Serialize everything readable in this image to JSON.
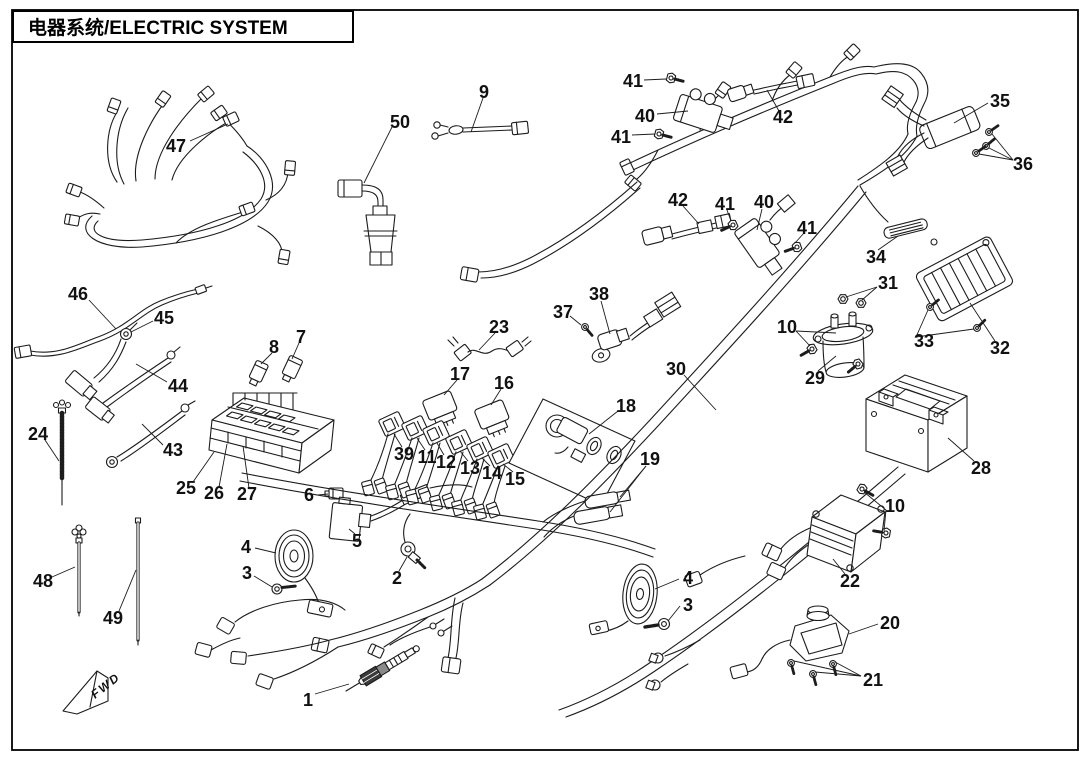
{
  "header": {
    "title": "电器系统/ELECTRIC SYSTEM"
  },
  "fwd_marker": {
    "label": "FWD"
  },
  "diagram": {
    "type": "exploded-parts-diagram",
    "subject": "Electric system wiring harness and components with numbered callouts",
    "callouts": [
      {
        "n": "47",
        "x": 176,
        "y": 146
      },
      {
        "n": "50",
        "x": 400,
        "y": 122
      },
      {
        "n": "9",
        "x": 484,
        "y": 92
      },
      {
        "n": "41",
        "x": 633,
        "y": 81
      },
      {
        "n": "40",
        "x": 645,
        "y": 116
      },
      {
        "n": "41",
        "x": 621,
        "y": 137
      },
      {
        "n": "42",
        "x": 783,
        "y": 117
      },
      {
        "n": "35",
        "x": 1000,
        "y": 101
      },
      {
        "n": "36",
        "x": 1023,
        "y": 164
      },
      {
        "n": "42",
        "x": 678,
        "y": 200
      },
      {
        "n": "41",
        "x": 725,
        "y": 204
      },
      {
        "n": "40",
        "x": 764,
        "y": 202
      },
      {
        "n": "41",
        "x": 807,
        "y": 228
      },
      {
        "n": "34",
        "x": 876,
        "y": 257
      },
      {
        "n": "31",
        "x": 888,
        "y": 283
      },
      {
        "n": "10",
        "x": 787,
        "y": 327
      },
      {
        "n": "29",
        "x": 815,
        "y": 378
      },
      {
        "n": "33",
        "x": 924,
        "y": 341
      },
      {
        "n": "32",
        "x": 1000,
        "y": 348
      },
      {
        "n": "28",
        "x": 981,
        "y": 468
      },
      {
        "n": "46",
        "x": 78,
        "y": 294
      },
      {
        "n": "45",
        "x": 164,
        "y": 318
      },
      {
        "n": "44",
        "x": 178,
        "y": 386
      },
      {
        "n": "43",
        "x": 173,
        "y": 450
      },
      {
        "n": "24",
        "x": 38,
        "y": 434
      },
      {
        "n": "25",
        "x": 186,
        "y": 488
      },
      {
        "n": "26",
        "x": 214,
        "y": 493
      },
      {
        "n": "27",
        "x": 247,
        "y": 494
      },
      {
        "n": "8",
        "x": 274,
        "y": 347
      },
      {
        "n": "7",
        "x": 301,
        "y": 337
      },
      {
        "n": "23",
        "x": 499,
        "y": 327
      },
      {
        "n": "17",
        "x": 460,
        "y": 374
      },
      {
        "n": "16",
        "x": 504,
        "y": 383
      },
      {
        "n": "37",
        "x": 563,
        "y": 312
      },
      {
        "n": "38",
        "x": 599,
        "y": 294
      },
      {
        "n": "18",
        "x": 626,
        "y": 406
      },
      {
        "n": "30",
        "x": 676,
        "y": 369
      },
      {
        "n": "19",
        "x": 650,
        "y": 459
      },
      {
        "n": "39",
        "x": 404,
        "y": 454
      },
      {
        "n": "11",
        "x": 427,
        "y": 457
      },
      {
        "n": "12",
        "x": 446,
        "y": 462
      },
      {
        "n": "13",
        "x": 470,
        "y": 468
      },
      {
        "n": "14",
        "x": 492,
        "y": 473
      },
      {
        "n": "15",
        "x": 515,
        "y": 479
      },
      {
        "n": "6",
        "x": 309,
        "y": 495
      },
      {
        "n": "5",
        "x": 357,
        "y": 541
      },
      {
        "n": "4",
        "x": 246,
        "y": 547
      },
      {
        "n": "3",
        "x": 247,
        "y": 573
      },
      {
        "n": "2",
        "x": 397,
        "y": 578
      },
      {
        "n": "48",
        "x": 43,
        "y": 581
      },
      {
        "n": "49",
        "x": 113,
        "y": 618
      },
      {
        "n": "1",
        "x": 308,
        "y": 700
      },
      {
        "n": "4",
        "x": 688,
        "y": 578
      },
      {
        "n": "3",
        "x": 688,
        "y": 605
      },
      {
        "n": "10",
        "x": 895,
        "y": 506
      },
      {
        "n": "22",
        "x": 850,
        "y": 581
      },
      {
        "n": "20",
        "x": 890,
        "y": 623
      },
      {
        "n": "21",
        "x": 873,
        "y": 680
      }
    ]
  }
}
